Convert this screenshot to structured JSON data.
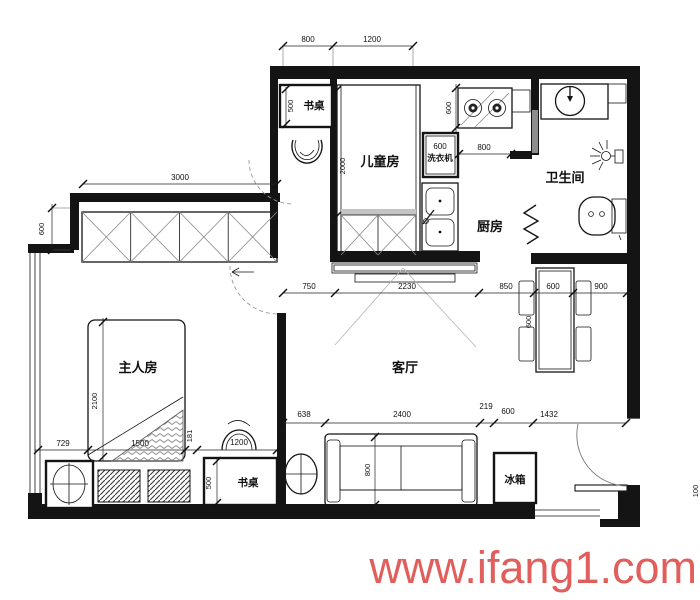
{
  "watermark": {
    "text": "www.ifang1.com",
    "color": "#e05f5c"
  },
  "rooms": {
    "children": "儿童房",
    "bathroom": "卫生间",
    "kitchen": "厨房",
    "master": "主人房",
    "living": "客厅"
  },
  "fixtures": {
    "desk_top": "书桌",
    "desk_bottom": "书桌",
    "washer": "洗衣机",
    "fridge": "冰箱"
  },
  "dims": {
    "top_800": "800",
    "top_1200": "1200",
    "stove_h_600": "600",
    "washer_w_600": "600",
    "kitchen_800": "800",
    "wardrobe_3000": "3000",
    "bay_600": "600",
    "children_bed_2000": "2000",
    "desk_top_500": "500",
    "mid_750": "750",
    "mid_2230": "2230",
    "mid_850": "850",
    "mid_600": "600",
    "mid_900": "900",
    "table_600": "600",
    "bed_2100": "2100",
    "left_729": "729",
    "left_1500": "1500",
    "left_181": "181",
    "chair_1200": "1200",
    "desk_bottom_500": "500",
    "bottom_638": "638",
    "bottom_2400": "2400",
    "bottom_219": "219",
    "bottom_600": "600",
    "bottom_1432": "1432",
    "sofa_800": "800",
    "right_100": "100"
  }
}
